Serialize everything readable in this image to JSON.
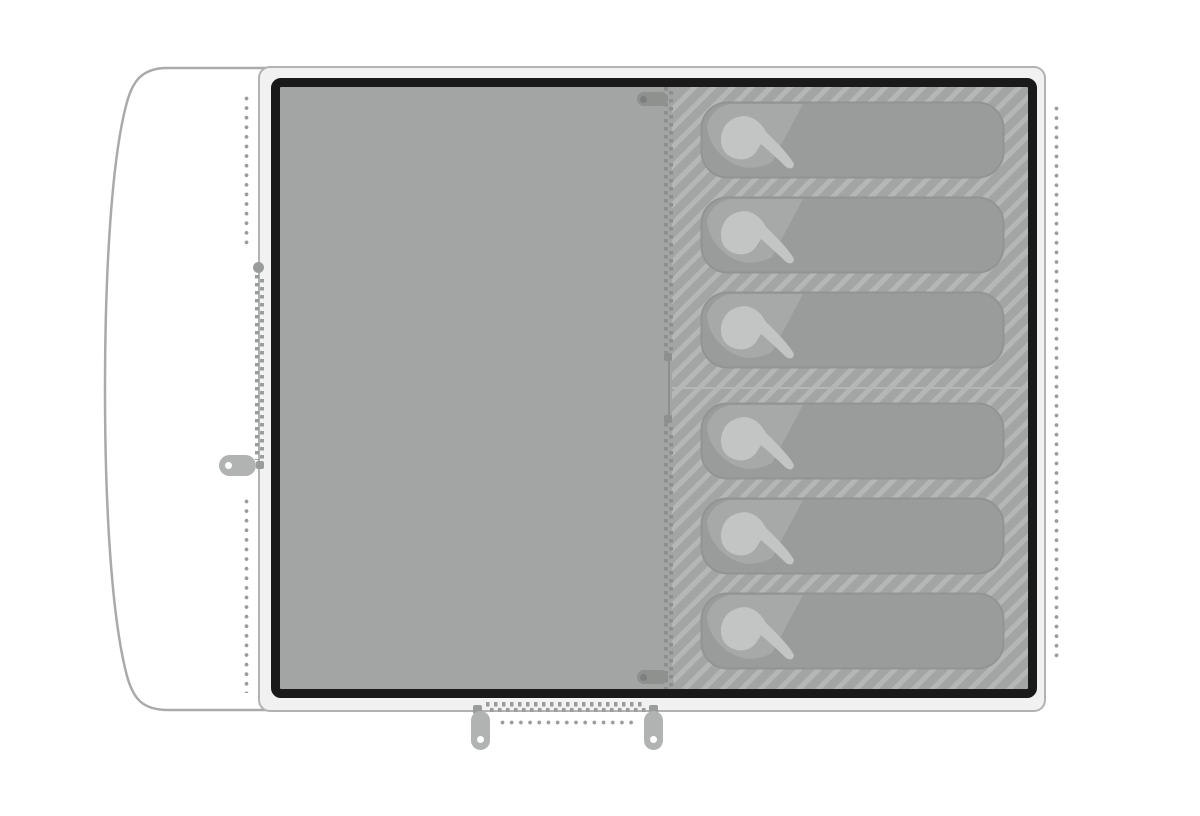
{
  "diagram": {
    "kind": "tent-floorplan",
    "counts": {
      "sleeping_bags": 6,
      "bedrooms": 2,
      "zipper_pulls": 5,
      "zipper_stops": 4,
      "dotted_seams": 4
    },
    "text": {}
  },
  "icons": {
    "sleeping-bag-icon": "rounded sleeping bag with light hood blob",
    "zipper-teeth": "offset double dash columns",
    "zipper-pull-icon": "pill tab with eyelet hole",
    "zipper-node-icon": "round slider connector",
    "seam-dots": "dotted stitch line"
  },
  "colors": {
    "page-bg": "#ffffff",
    "shell-band": "#f1f1f1",
    "shell-stroke": "#b1b3b2",
    "outline-stroke": "#a9abaa",
    "border-dark": "#1a1a1a",
    "floor-fill": "#a3a5a4",
    "hatch-stripe": "#b5b7b6",
    "bag-fill": "#9a9c9b",
    "bag-edge": "#929491",
    "bag-flap": "#a7a9a8",
    "bag-hood": "#c3c5c4",
    "zip-outer": "#9a9c9b",
    "zip-inner": "#8d8f8e",
    "pull-outer": "#b1b3b2",
    "pull-inner": "#8f918f",
    "pull-hole-inner": "#7d7f7e",
    "divider": "#b5b7b6",
    "dot": "#9a9c9b"
  }
}
